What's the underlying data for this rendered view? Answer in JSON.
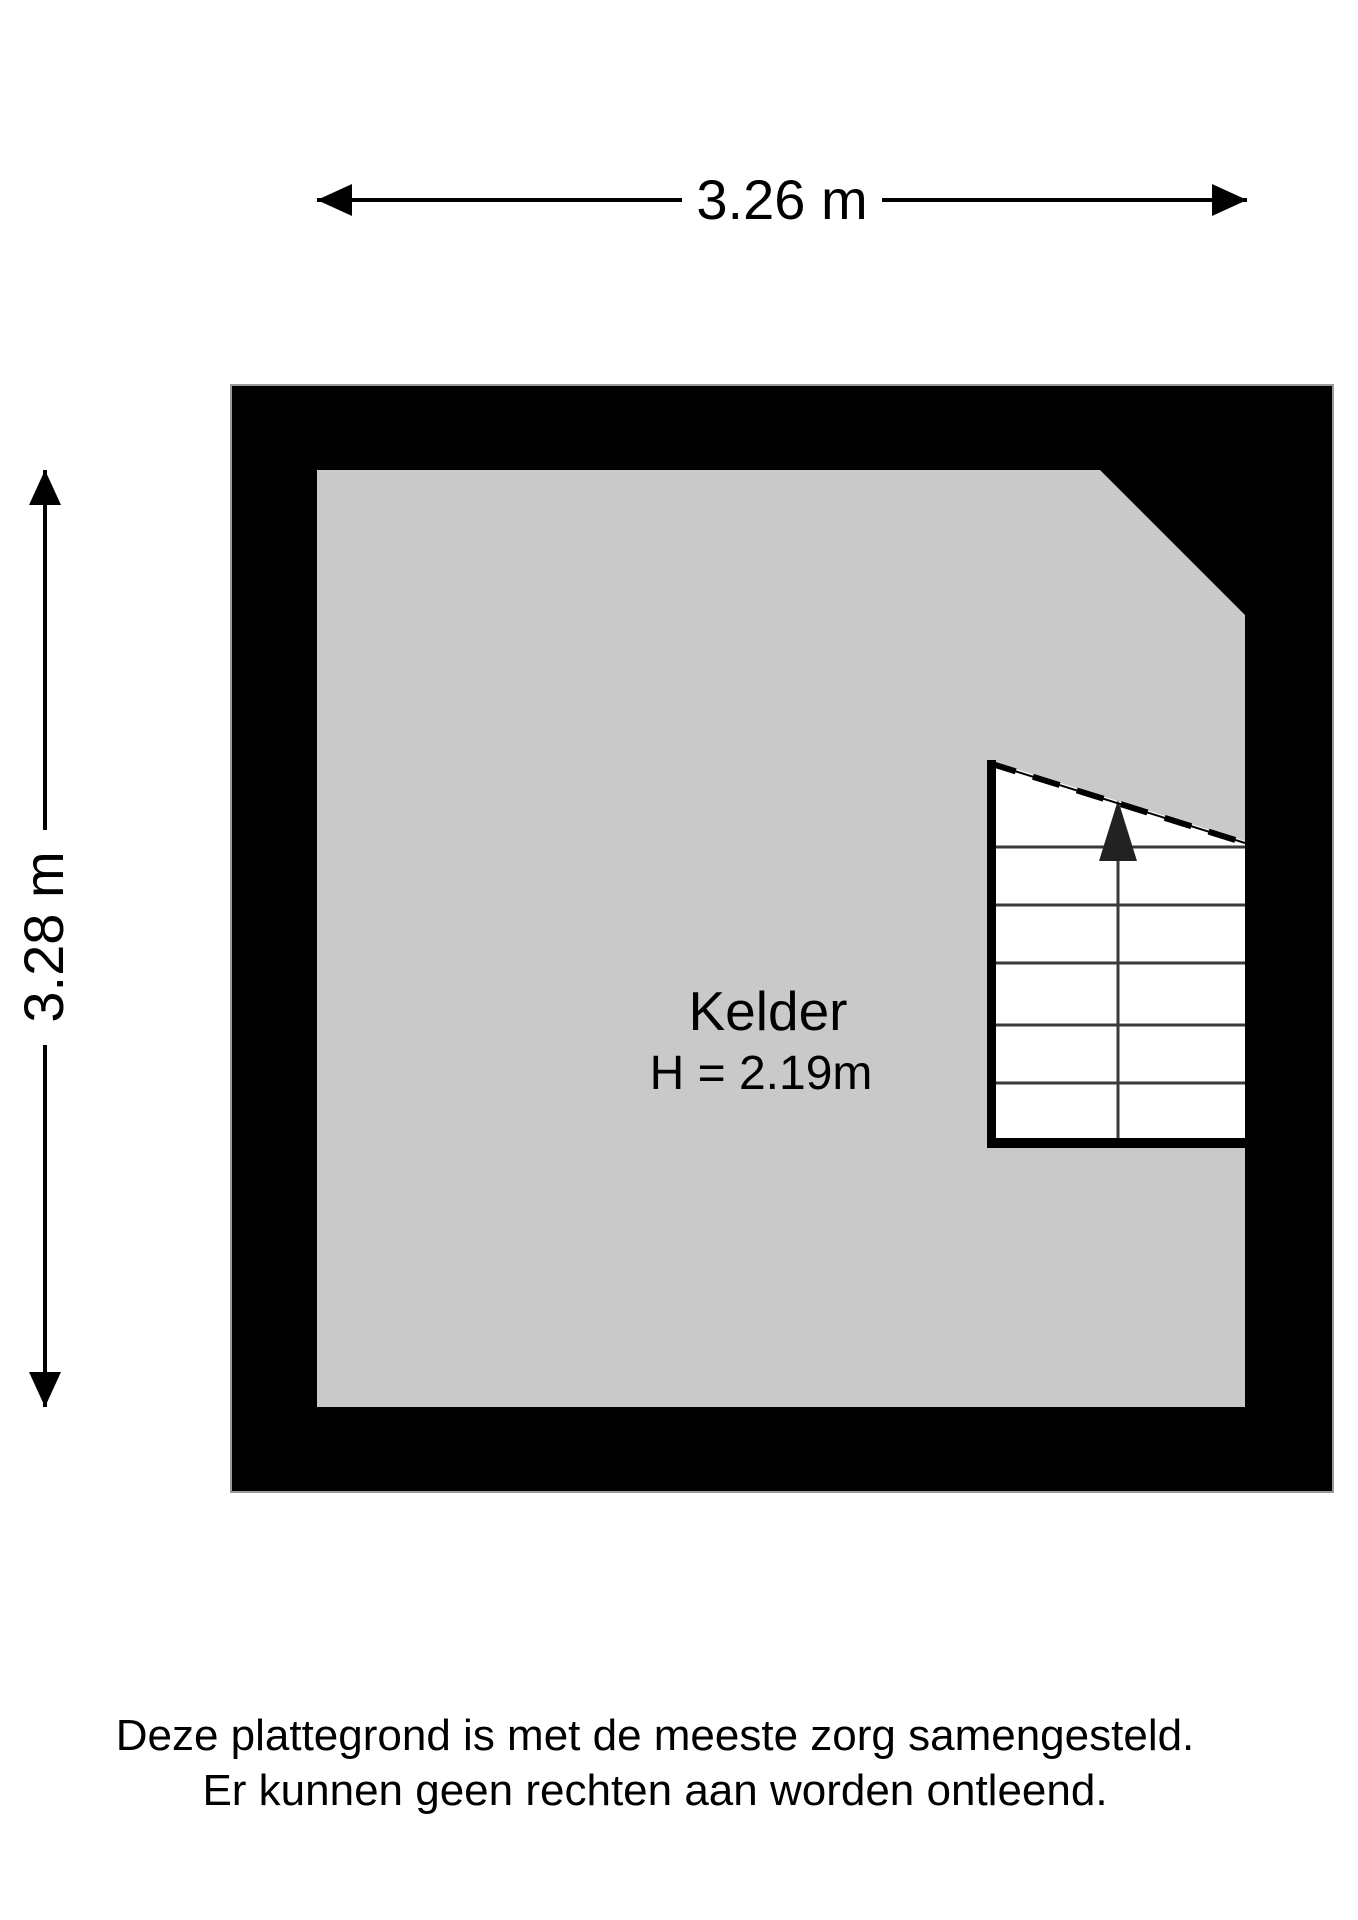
{
  "page": {
    "type": "floorplan",
    "background": "#ffffff"
  },
  "dimensions": {
    "top": {
      "label": "3.26 m"
    },
    "left": {
      "label": "3.28 m"
    }
  },
  "room": {
    "name": "Kelder",
    "ceiling_height": "H = 2.19m"
  },
  "icons": {
    "top_dimension": "left-right-measure-arrow",
    "left_dimension": "up-down-measure-arrow",
    "stairs_direction": "stairs-up-arrow"
  },
  "colors": {
    "wall": "#000000",
    "wall_outline": "#9a9a9a",
    "floor": "#c9c9c9",
    "stairs_fill": "#ffffff",
    "stair_tread": "#3a3a3a",
    "text": "#000000"
  },
  "disclaimer": {
    "line1": "Deze plattegrond is met de meeste zorg samengesteld.",
    "line2": "Er kunnen geen rechten aan worden ontleend."
  }
}
